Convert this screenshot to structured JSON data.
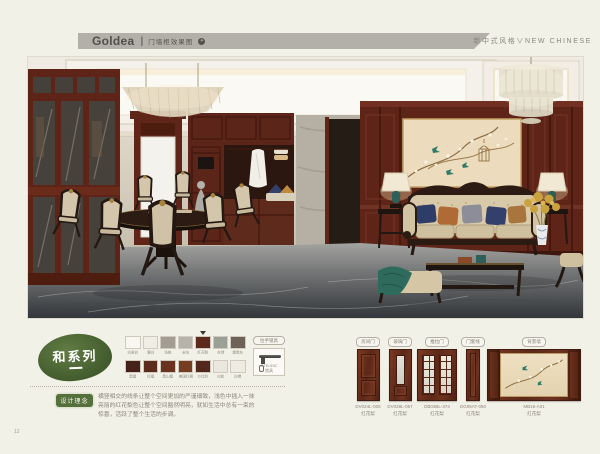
{
  "header": {
    "brand": "Goldea",
    "divider": "|",
    "subtitle": "门墙柜效果图",
    "icon": "✦",
    "right_text": "新中式风格∨NEW CHINESE",
    "bar_color": "#b2b0a8"
  },
  "page": {
    "number": "12",
    "background": "#f2f1e8"
  },
  "series": {
    "badge": "和系列",
    "badge_color": "#4a6232",
    "design_label": "设计理念",
    "description": "横竖相交的线条让整个空间更加的严谨细致，浅色中插入一抹亮丽的红花梨色让整个空间豁然明亮，就如生活中总有一束的惊喜，活跃了整个生活的步调。"
  },
  "swatches": {
    "row1": [
      {
        "label": "白瓷白",
        "color": "#f7f6f1"
      },
      {
        "label": "暖白",
        "color": "#efede4"
      },
      {
        "label": "浅咖",
        "color": "#a29e93"
      },
      {
        "label": "米灰",
        "color": "#b6b3ab"
      },
      {
        "label": "红花梨",
        "color": "#5c2a1b",
        "selected": true
      },
      {
        "label": "灰绿",
        "color": "#9aa096"
      },
      {
        "label": "烟熏灰",
        "color": "#6e6258"
      }
    ],
    "row2": [
      {
        "label": "黑檀",
        "color": "#46211a"
      },
      {
        "label": "红檀",
        "color": "#5b2b1d"
      },
      {
        "label": "黑山檀",
        "color": "#6a3320"
      },
      {
        "label": "美国红枫",
        "color": "#753d22"
      },
      {
        "label": "沙比利",
        "color": "#53281c"
      },
      {
        "label": "白松",
        "color": "#e9e7de"
      },
      {
        "label": "白橡",
        "color": "#edebe2"
      }
    ],
    "hardware": {
      "badge": "拉手锁具",
      "code": "GTB-53C",
      "name": "锁具"
    }
  },
  "products": [
    {
      "tag": "房间门",
      "code": "DV024L-005",
      "material": "红花梨"
    },
    {
      "tag": "玻璃门",
      "code": "DV028L-067",
      "material": "红花梨"
    },
    {
      "tag": "推拉门",
      "code": "DB03BL-374",
      "material": "红花梨"
    },
    {
      "tag": "门套线",
      "code": "DG06AT-050",
      "material": "红花梨"
    },
    {
      "tag": "背景墙",
      "code": "MB16-A01",
      "material": "红花梨"
    }
  ]
}
